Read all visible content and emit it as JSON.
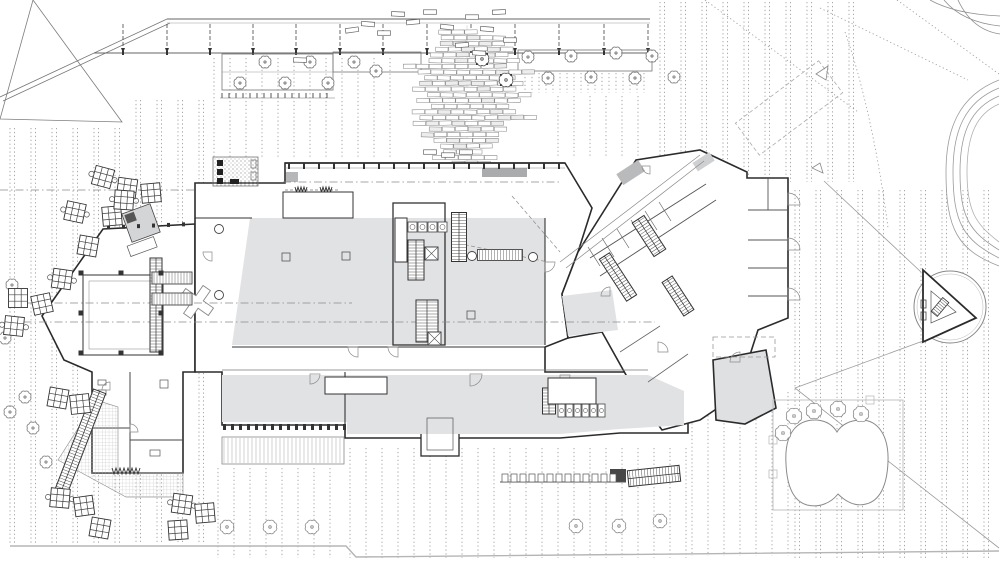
{
  "drawing": {
    "kind": "architectural-site-plan-ground-floor"
  },
  "palette": {
    "background": "#ffffff",
    "wall": "#2b2b2b",
    "line_medium": "#666666",
    "line_light": "#9b9b9b",
    "paving_dot": "#a0a0a0",
    "floor_gray": "#e1e2e4",
    "floor_gray_dark": "#b8babc",
    "canopy_gray": "#a9abad",
    "hatch": "#555555",
    "boundary": "#b5b5b5"
  },
  "paving_regions": [
    {
      "x0": 10,
      "x1": 206,
      "y0": 100,
      "y1": 544,
      "step": 21,
      "pair": true,
      "clip_triangle": true
    },
    {
      "x0": 214,
      "x1": 392,
      "y0": 58,
      "y1": 158,
      "step": 16,
      "pair": false
    },
    {
      "x0": 558,
      "x1": 652,
      "y0": 96,
      "y1": 158,
      "step": 16,
      "pair": false
    },
    {
      "x0": 525,
      "x1": 650,
      "y0": 73,
      "y1": 93,
      "step": 7,
      "pair": false
    },
    {
      "x0": 660,
      "x1": 856,
      "y0": 2,
      "y1": 182,
      "step": 21,
      "pair": true
    },
    {
      "x0": 795,
      "x1": 996,
      "y0": 190,
      "y1": 560,
      "step": 21,
      "pair": true
    },
    {
      "x0": 350,
      "x1": 688,
      "y0": 448,
      "y1": 558,
      "step": 16,
      "pair": false
    },
    {
      "x0": 218,
      "x1": 344,
      "y0": 468,
      "y1": 558,
      "step": 16,
      "pair": false
    },
    {
      "x0": 692,
      "x1": 788,
      "y0": 392,
      "y1": 556,
      "step": 16,
      "pair": false
    }
  ],
  "centerlines": [
    [
      8,
      303,
      352,
      303
    ],
    [
      8,
      322,
      655,
      322
    ],
    [
      283,
      182,
      562,
      182
    ],
    [
      0,
      190,
      195,
      190
    ]
  ],
  "canopy": {
    "diag": [
      0,
      97,
      167,
      19
    ],
    "x0": 167,
    "x1": 650,
    "y_top": 19,
    "y_bot": 53,
    "arrow_xs": [
      123,
      167,
      210,
      253,
      296,
      340,
      383,
      427,
      471,
      515,
      559,
      604,
      648
    ]
  },
  "planter_strips": [
    [
      222,
      54,
      111,
      36
    ],
    [
      333,
      52,
      88,
      20
    ],
    [
      518,
      50,
      134,
      21
    ]
  ],
  "tick_rows": [
    {
      "x0": 222,
      "x1": 333,
      "y": 93,
      "step": 7,
      "len": 5
    },
    {
      "x0": 350,
      "x1": 556,
      "y": 433,
      "step": 10,
      "len": 5
    },
    {
      "x0": 282,
      "x1": 446,
      "y": 363,
      "step": 8,
      "len": 5
    }
  ],
  "cascade": {
    "cx": 467,
    "y0": 30,
    "y1": 171,
    "row_h": 5.7,
    "brick_w": 12.4,
    "brick_h": 4.2,
    "seed": 7
  },
  "trees": {
    "plaza": [
      [
        12,
        285
      ],
      [
        5,
        338
      ],
      [
        25,
        397
      ],
      [
        10,
        412
      ],
      [
        33,
        428
      ],
      [
        46,
        462
      ],
      [
        674,
        77
      ]
    ],
    "band": [
      [
        265,
        62
      ],
      [
        310,
        62
      ],
      [
        240,
        83
      ],
      [
        285,
        83
      ],
      [
        328,
        83
      ],
      [
        354,
        62
      ],
      [
        376,
        71
      ],
      [
        528,
        57
      ],
      [
        571,
        56
      ],
      [
        616,
        53
      ],
      [
        652,
        56
      ],
      [
        548,
        78
      ],
      [
        591,
        77
      ],
      [
        635,
        78
      ]
    ],
    "bottom": [
      [
        227,
        527
      ],
      [
        270,
        527
      ],
      [
        312,
        527
      ],
      [
        576,
        526
      ],
      [
        619,
        526
      ],
      [
        660,
        521
      ]
    ],
    "pond": [
      [
        783,
        433
      ],
      [
        794,
        416
      ],
      [
        814,
        411
      ],
      [
        838,
        409
      ],
      [
        861,
        414
      ]
    ],
    "planter": [
      [
        482,
        59
      ],
      [
        506,
        80
      ]
    ]
  },
  "tables": [
    [
      103,
      177,
      15
    ],
    [
      127,
      188,
      8
    ],
    [
      151,
      193,
      -5
    ],
    [
      75,
      212,
      12
    ],
    [
      112,
      216,
      -5
    ],
    [
      88,
      246,
      10
    ],
    [
      62,
      279,
      8
    ],
    [
      18,
      298,
      0
    ],
    [
      42,
      304,
      -12
    ],
    [
      14,
      326,
      6
    ],
    [
      58,
      398,
      10
    ],
    [
      80,
      404,
      -6
    ],
    [
      60,
      498,
      5
    ],
    [
      84,
      506,
      -8
    ],
    [
      100,
      528,
      10
    ],
    [
      182,
      504,
      8
    ],
    [
      205,
      513,
      -5
    ],
    [
      178,
      530,
      -4
    ],
    [
      124,
      200,
      4
    ]
  ],
  "benches": [
    [
      352,
      30,
      -8
    ],
    [
      368,
      24,
      5
    ],
    [
      384,
      33,
      0
    ],
    [
      398,
      14,
      3
    ],
    [
      413,
      22,
      -5
    ],
    [
      430,
      12,
      0
    ],
    [
      447,
      27,
      6
    ],
    [
      462,
      45,
      -4
    ],
    [
      472,
      17,
      0
    ],
    [
      487,
      29,
      5
    ],
    [
      499,
      12,
      -3
    ],
    [
      510,
      40,
      0
    ],
    [
      479,
      53,
      4
    ],
    [
      300,
      60,
      2
    ],
    [
      430,
      152,
      0
    ],
    [
      448,
      155,
      0
    ],
    [
      466,
      152,
      0
    ]
  ],
  "facade": {
    "y": 163,
    "x0": 288,
    "x1": 563,
    "step": 15
  },
  "colonnade": {
    "y": 424,
    "x0": 223,
    "x1": 344,
    "step": 8
  },
  "deck": {
    "x": 222,
    "y": 437,
    "w": 122,
    "h": 27,
    "step": 4
  },
  "terrace_cells": {
    "y": 474,
    "x0": 502,
    "x1": 618,
    "step": 9
  },
  "stairs": [
    [
      459,
      237,
      15,
      49,
      0
    ],
    [
      416,
      260,
      16,
      40,
      0
    ],
    [
      427,
      321,
      22,
      42,
      0
    ],
    [
      649,
      236,
      14,
      40,
      -33
    ],
    [
      618,
      277,
      12,
      50,
      -33
    ],
    [
      678,
      296,
      12,
      40,
      -33
    ],
    [
      549,
      401,
      13,
      26,
      0
    ],
    [
      654,
      476,
      52,
      16,
      -6
    ],
    [
      79,
      445,
      13,
      115,
      21
    ],
    [
      156,
      305,
      12,
      94,
      0
    ],
    [
      940,
      307,
      8,
      18,
      40
    ]
  ],
  "bridges": [
    [
      172,
      278,
      40,
      12
    ],
    [
      172,
      299,
      40,
      12
    ],
    [
      500,
      255,
      45,
      11
    ]
  ],
  "elevators": [
    [
      425,
      247
    ],
    [
      428,
      332
    ]
  ],
  "columns": [
    [
      219,
      229
    ],
    [
      219,
      295
    ],
    [
      472,
      256
    ],
    [
      533,
      257
    ]
  ],
  "open_squares": [
    [
      286,
      257
    ],
    [
      346,
      256
    ],
    [
      471,
      315
    ]
  ],
  "door_arcs": [
    [
      310,
      374,
      10,
      0
    ],
    [
      358,
      347,
      10,
      90
    ],
    [
      398,
      347,
      10,
      90
    ],
    [
      470,
      374,
      12,
      0
    ],
    [
      560,
      375,
      10,
      0
    ],
    [
      610,
      296,
      9,
      180
    ],
    [
      658,
      352,
      10,
      270
    ],
    [
      788,
      205,
      12,
      270
    ],
    [
      788,
      250,
      12,
      270
    ],
    [
      788,
      300,
      12,
      270
    ],
    [
      740,
      362,
      10,
      180
    ],
    [
      130,
      432,
      8,
      270
    ],
    [
      110,
      390,
      8,
      180
    ],
    [
      212,
      252,
      9,
      90
    ],
    [
      545,
      262,
      10,
      0
    ],
    [
      650,
      166,
      8,
      90
    ]
  ],
  "zigzags": [
    [
      295,
      187,
      4,
      12,
      5
    ],
    [
      320,
      187,
      4,
      12,
      5
    ],
    [
      112,
      468,
      7,
      28,
      6
    ]
  ],
  "dashed_rects": [
    [
      713,
      337,
      62,
      20
    ]
  ],
  "toilet_rows": [
    {
      "x": 408,
      "y": 222,
      "n": 4,
      "cw": 9,
      "ch": 10
    },
    {
      "x": 558,
      "y": 404,
      "n": 6,
      "cw": 7,
      "ch": 13
    }
  ],
  "white_rooms": [
    [
      325,
      377,
      62,
      17
    ],
    [
      548,
      378,
      48,
      26
    ],
    [
      395,
      218,
      12,
      44
    ],
    [
      283,
      192,
      70,
      26
    ]
  ],
  "pond": {
    "border": [
      773,
      400,
      130,
      110
    ]
  },
  "kiosk": {
    "circle": [
      950,
      307,
      36
    ],
    "triangle": "923,270 976,318 923,342",
    "inner": "931,291 956,312 931,323"
  }
}
